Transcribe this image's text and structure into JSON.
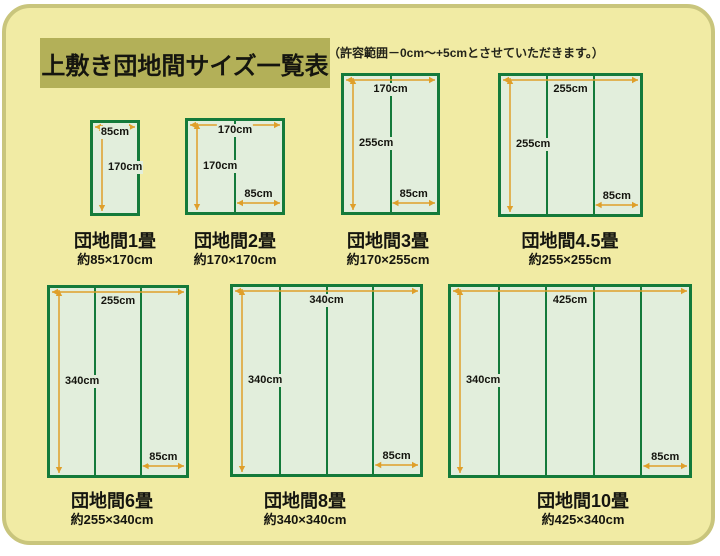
{
  "page": {
    "title": "上敷き団地間サイズ一覧表",
    "tolerance_note": "（許容範囲－0cm～+5cmとさせていただきます。）"
  },
  "colors": {
    "panel_bg": "#f1eba4",
    "panel_border": "#c9c57c",
    "title_box_bg": "#b3b058",
    "mat_fill": "#e2eedc",
    "mat_border": "#147a3a",
    "arrow": "#df9f2a",
    "text": "#15150f"
  },
  "diagrams": [
    {
      "id": "1jo",
      "title": "団地間1畳",
      "size_label": "約85×170cm",
      "width_label": "85cm",
      "height_label": "170cm",
      "mat_width_label": null,
      "columns": 1,
      "rect": {
        "x": 90,
        "y": 120,
        "w": 50,
        "h": 96
      },
      "label_center_x": 115,
      "title_top": 227,
      "size_top": 249
    },
    {
      "id": "2jo",
      "title": "団地間2畳",
      "size_label": "約170×170cm",
      "width_label": "170cm",
      "height_label": "170cm",
      "mat_width_label": "85cm",
      "columns": 2,
      "rect": {
        "x": 185,
        "y": 118,
        "w": 100,
        "h": 97
      },
      "label_center_x": 235,
      "title_top": 227,
      "size_top": 249
    },
    {
      "id": "3jo",
      "title": "団地間3畳",
      "size_label": "約170×255cm",
      "width_label": "170cm",
      "height_label": "255cm",
      "mat_width_label": "85cm",
      "columns": 2,
      "rect": {
        "x": 341,
        "y": 73,
        "w": 99,
        "h": 142
      },
      "label_center_x": 388,
      "title_top": 227,
      "size_top": 249
    },
    {
      "id": "4-5jo",
      "title": "団地間4.5畳",
      "size_label": "約255×255cm",
      "width_label": "255cm",
      "height_label": "255cm",
      "mat_width_label": "85cm",
      "columns": 3,
      "rect": {
        "x": 498,
        "y": 73,
        "w": 145,
        "h": 144
      },
      "label_center_x": 570,
      "title_top": 227,
      "size_top": 249
    },
    {
      "id": "6jo",
      "title": "団地間6畳",
      "size_label": "約255×340cm",
      "width_label": "255cm",
      "height_label": "340cm",
      "mat_width_label": "85cm",
      "columns": 3,
      "rect": {
        "x": 47,
        "y": 285,
        "w": 142,
        "h": 193
      },
      "label_center_x": 112,
      "title_top": 487,
      "size_top": 509
    },
    {
      "id": "8jo",
      "title": "団地間8畳",
      "size_label": "約340×340cm",
      "width_label": "340cm",
      "height_label": "340cm",
      "mat_width_label": "85cm",
      "columns": 4,
      "rect": {
        "x": 230,
        "y": 284,
        "w": 193,
        "h": 193
      },
      "label_center_x": 305,
      "title_top": 487,
      "size_top": 509
    },
    {
      "id": "10jo",
      "title": "団地間10畳",
      "size_label": "約425×340cm",
      "width_label": "425cm",
      "height_label": "340cm",
      "mat_width_label": "85cm",
      "columns": 5,
      "rect": {
        "x": 448,
        "y": 284,
        "w": 244,
        "h": 194
      },
      "label_center_x": 583,
      "title_top": 487,
      "size_top": 509
    }
  ]
}
